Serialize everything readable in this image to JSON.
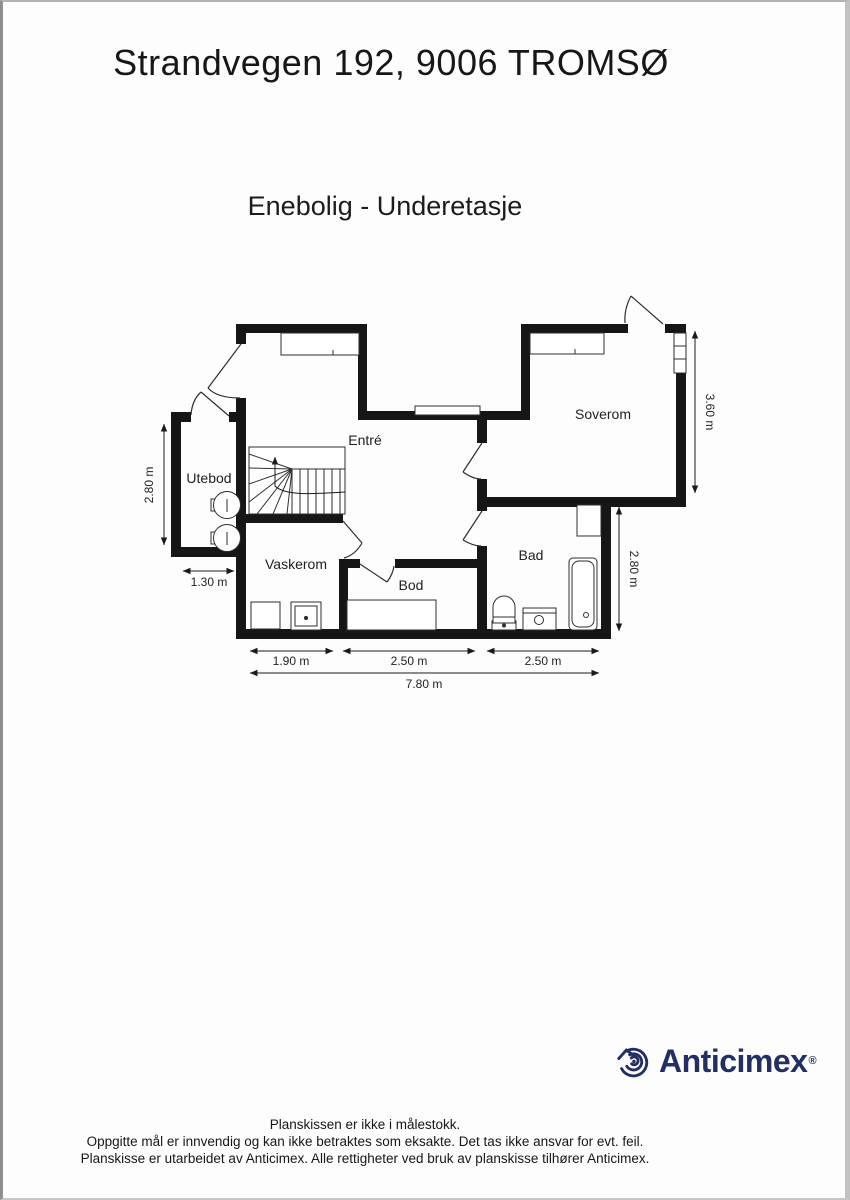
{
  "page": {
    "title": "Strandvegen 192, 9006 TROMSØ",
    "subtitle": "Enebolig - Underetasje"
  },
  "rooms": {
    "entre": "Entré",
    "soverom": "Soverom",
    "utebod": "Utebod",
    "vaskerom": "Vaskerom",
    "bod": "Bod",
    "bad": "Bad"
  },
  "dims": {
    "left_280": "2.80 m",
    "utebod_130": "1.30 m",
    "soverom_360": "3.60 m",
    "bad_280": "2.80 m",
    "w_190": "1.90 m",
    "w_250a": "2.50 m",
    "w_250b": "2.50 m",
    "w_780": "7.80 m"
  },
  "branding": {
    "logo_text": "Anticimex",
    "registered": "®",
    "brand_color": "#232f63"
  },
  "footer": {
    "line1": "Planskissen er ikke i målestokk.",
    "line2": "Oppgitte mål er innvendig og kan ikke betraktes som eksakte. Det tas ikke ansvar for evt. feil.",
    "line3": "Planskisse er utarbeidet av Anticimex. Alle rettigheter ved bruk av planskisse tilhører Anticimex."
  }
}
